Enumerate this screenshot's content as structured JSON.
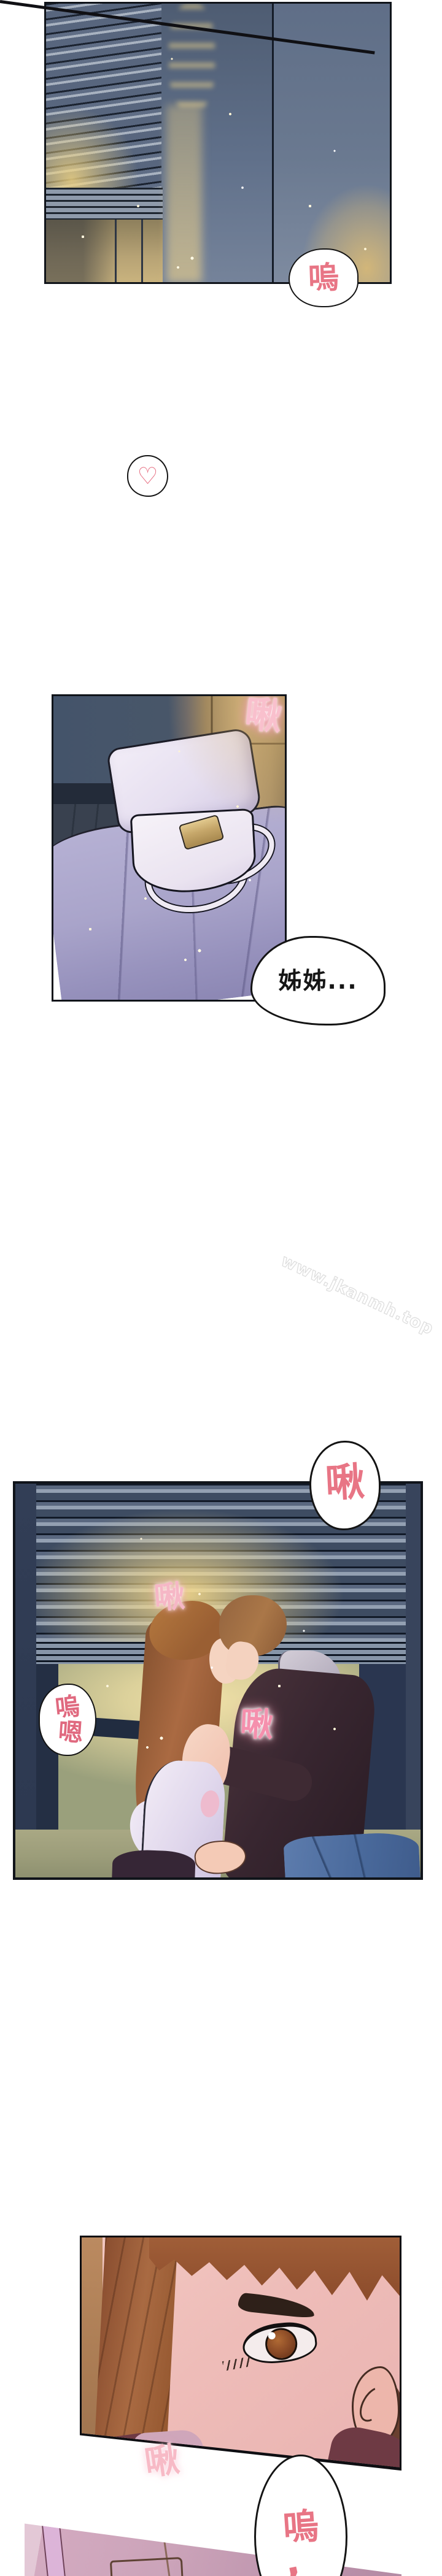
{
  "page": {
    "background": "#ffffff"
  },
  "colors": {
    "sfx_pink": "#e87585",
    "sfx_soft_pink": "#f6b6c2",
    "sfx_glow_pink": "#f590ad",
    "heart_pink": "#e66a7e",
    "panel_border": "#10141a",
    "bubble_outline": "#141414",
    "blinds_warm_glow": "#eed282",
    "night_wall_blue": "#60708a"
  },
  "watermark": {
    "text": "www.jkanmh.top"
  },
  "panel1": {
    "bubble_sob": "嗚"
  },
  "heart_bubble": {
    "symbol": "♡"
  },
  "panel2": {
    "sfx_kiss": "啾",
    "bubble_call": "姊姊..."
  },
  "panel3": {
    "bubble_kiss": "啾",
    "sfx_kiss_soft": "啾",
    "sfx_kiss_glow": "啾",
    "moan_line1": "嗚",
    "moan_line2": "嗯"
  },
  "panel4": {
    "sfx_kiss": "啾"
  },
  "bottom_bubble": {
    "line1": "嗚",
    "line2": ","
  }
}
